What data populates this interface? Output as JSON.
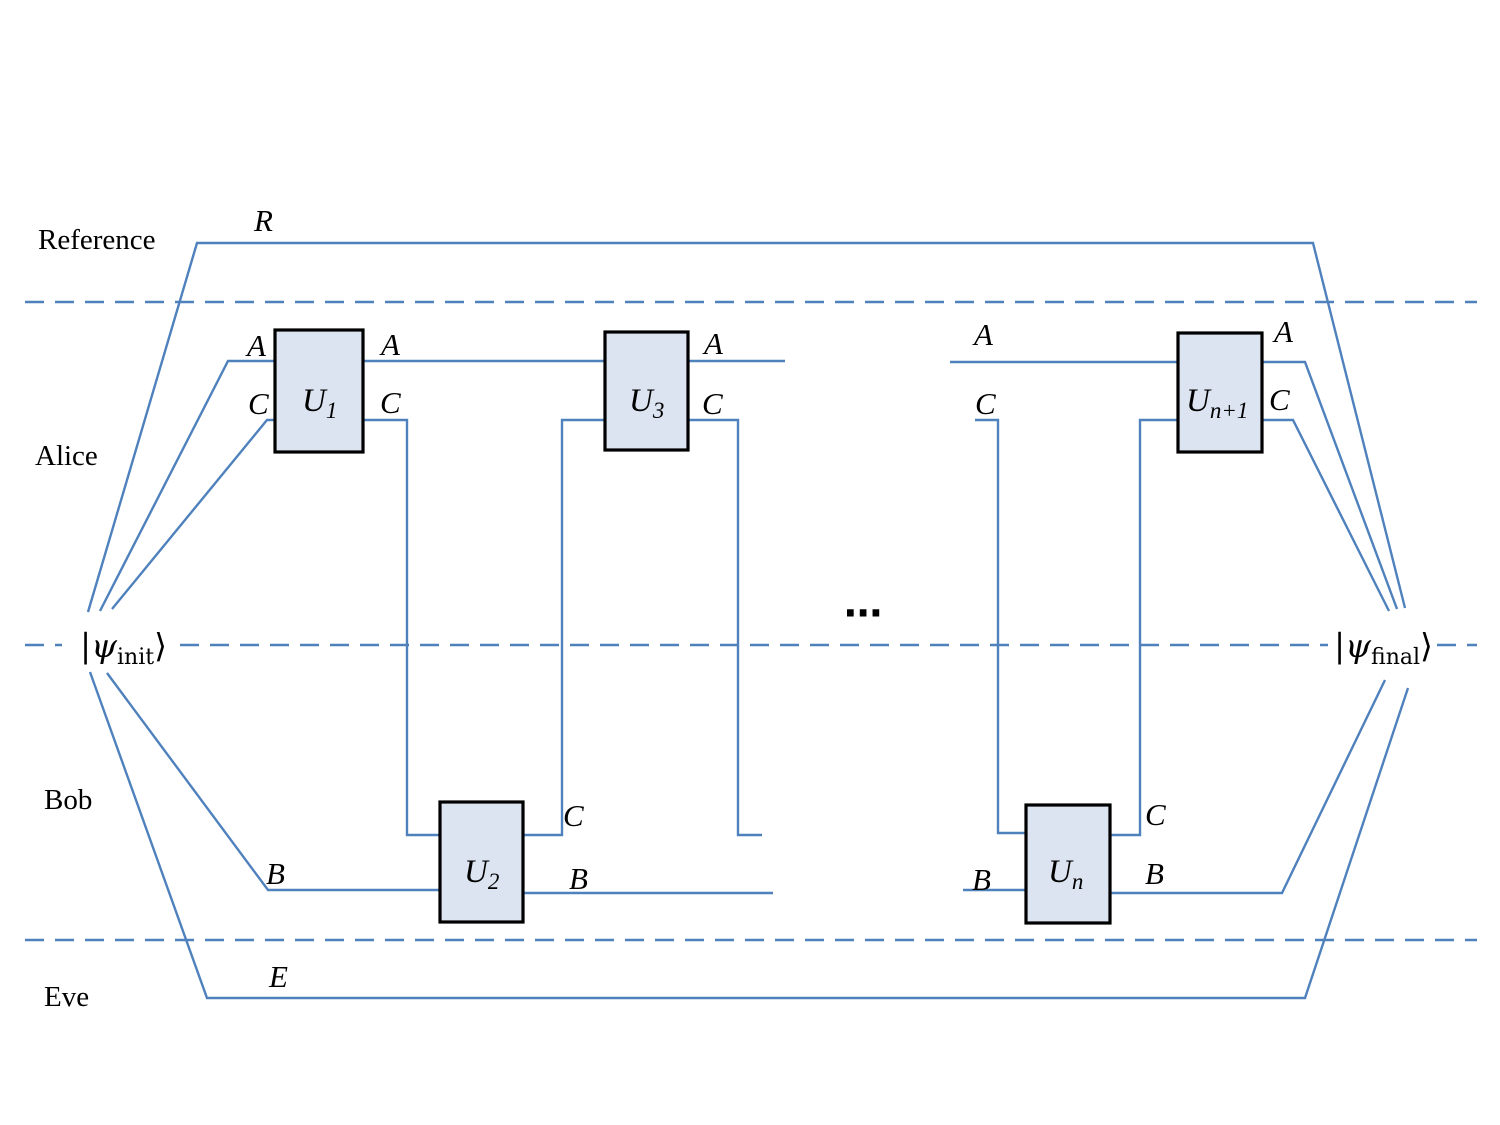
{
  "regions": {
    "reference": "Reference",
    "alice": "Alice",
    "bob": "Bob",
    "eve": "Eve"
  },
  "states": {
    "init": {
      "bar": "|",
      "psi": "ψ",
      "sub": "init",
      "ket": "⟩"
    },
    "final": {
      "bar": "|",
      "psi": "ψ",
      "sub": "final",
      "ket": "⟩"
    }
  },
  "gates": {
    "u1": {
      "base": "U",
      "sub": "1"
    },
    "u2": {
      "base": "U",
      "sub": "2"
    },
    "u3": {
      "base": "U",
      "sub": "3"
    },
    "un": {
      "base": "U",
      "sub": "n"
    },
    "un1": {
      "base": "U",
      "sub": "n+1"
    }
  },
  "wire_letters": {
    "r": "R",
    "a": "A",
    "b": "B",
    "c": "C",
    "e": "E"
  },
  "ellipsis": "⋯",
  "colors": {
    "wire": "#4f81bd",
    "gate_fill": "#dbe4f0",
    "gate_border": "#000000",
    "text": "#000000"
  }
}
